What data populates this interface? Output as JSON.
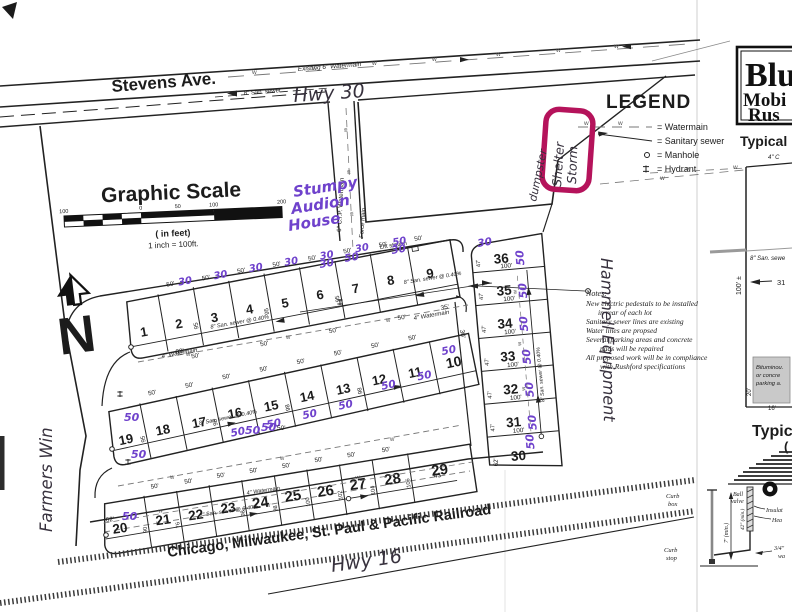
{
  "streets": {
    "stevens": "Stevens Ave.",
    "railroad": "Chicago, Milwaukee, St. Paul & Pacific Railroad"
  },
  "legend": {
    "title": "LEGEND",
    "watermain": "= Watermain",
    "sanitary": "= Sanitary sewer",
    "manhole": "= Manhole",
    "hydrant": "= Hydrant"
  },
  "scale": {
    "title": "Graphic Scale",
    "tick_left100": "100",
    "tick_0": "0",
    "tick_50": "50",
    "tick_100": "100",
    "tick_200": "200",
    "units": "( in feet)",
    "ratio": "1 inch =  100ft."
  },
  "north": {
    "letter": "N"
  },
  "labels": {
    "existing_wm": "Existing 6\" Watermain",
    "san8": "8\" San. sewer",
    "san8grade": "8\" San. sewer @ 0.40%",
    "cip6": "6\" C.I.P. Watermain",
    "force_main": "Force main",
    "wm4": "4\" Watermain",
    "lift": "Lift station",
    "w": "w"
  },
  "handwriting": {
    "hwy30": "Hwy 30",
    "hwy16": "Hwy 16",
    "stumpy1": "Stumpy",
    "stumpy2": "Audion",
    "stumpy3": "House",
    "storm1": "Storm",
    "storm2": "Shelter",
    "dumpster": "dumpster",
    "hammell": "Hammell Equipment",
    "farmers": "Farmers Win",
    "m30": "30",
    "m50": "50"
  },
  "notes": {
    "title": "Notes:",
    "l1": "New electric pedestals to be installed",
    "l2": "in rear of each lot",
    "l3": "Sanitary sewer lines are existing",
    "l4": "Water lines are propsed",
    "l5": "Several parking areas and concrete",
    "l6": "pads will be repaired",
    "l7": "All proposed work will be in compliance",
    "l8": "with Rushford specifications"
  },
  "lots": [
    "1",
    "2",
    "3",
    "4",
    "5",
    "6",
    "7",
    "8",
    "9",
    "10",
    "11",
    "12",
    "13",
    "14",
    "15",
    "16",
    "17",
    "18",
    "19",
    "20",
    "21",
    "22",
    "23",
    "24",
    "25",
    "26",
    "27",
    "28",
    "29",
    "30",
    "31",
    "32",
    "33",
    "34",
    "35",
    "36"
  ],
  "dims": {
    "d50": "50'",
    "d100": "100'",
    "d47": "47'",
    "d35": "35'",
    "d30": "30'",
    "d43": "43'",
    "d62": "62'",
    "d83": "83'",
    "d90": "90",
    "d76": "76",
    "d95": "95",
    "d98": "98",
    "d100n": "100",
    "d102": "102",
    "d104": "104",
    "d106": "106"
  },
  "panel": {
    "title1": "Blu",
    "title2": "Mobi",
    "title3": "Rus",
    "typical_top": "Typical",
    "c4": "4\" C",
    "san8": "8\" San. sewe",
    "dim100": "100' ±",
    "lot31": "31",
    "bit1": "Bituminou.",
    "bit2": "or concre",
    "bit3": "parking a.",
    "d20": "20'",
    "d16": "16'",
    "typical_bottom": "Typic",
    "paren": "(",
    "curb1": "Curb",
    "box": "box",
    "curb2": "Curb",
    "stop": "stop",
    "ball": "Ball",
    "valve": "valve",
    "d7min": "7' (min.)",
    "d42min": "42\" (min.)",
    "insulat": "Insulat",
    "hea": "Hea",
    "tq": "3/4\"",
    "wa": "wa"
  },
  "colors": {
    "highlight": "#b5135b",
    "purple_ink": "#6f42cc",
    "black_ink": "#37313d"
  }
}
